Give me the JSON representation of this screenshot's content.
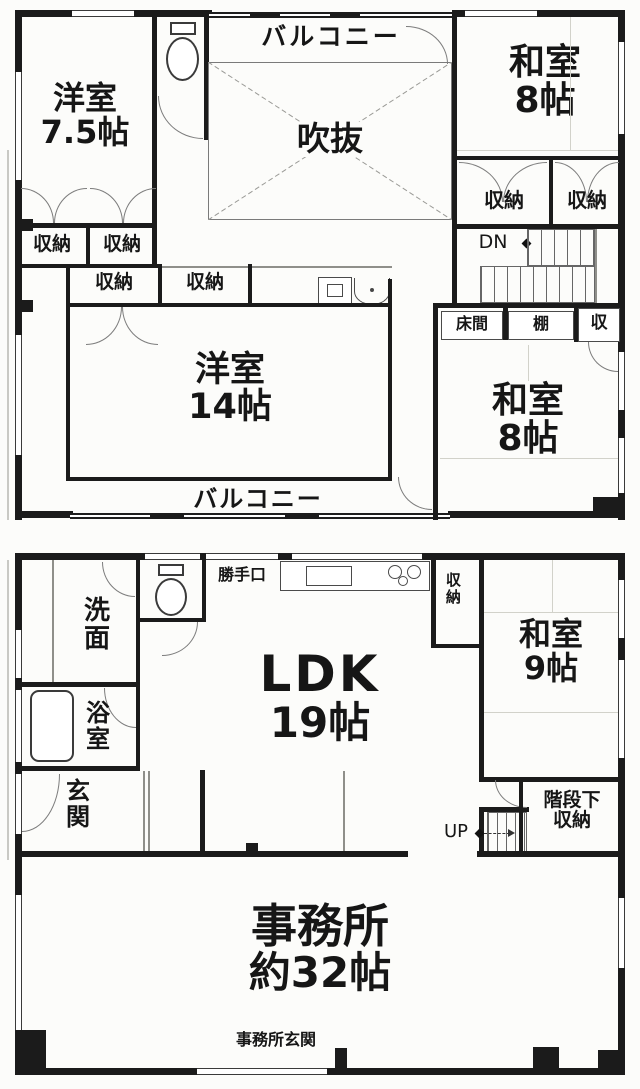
{
  "floor2": {
    "yoshitsu75": {
      "name": "洋室",
      "size": "7.5帖"
    },
    "balcony_top": "バルコニー",
    "fukinuke": "吹抜",
    "washitsu8_ne": {
      "name": "和室",
      "size": "8帖"
    },
    "closets": [
      "収納",
      "収納",
      "収納",
      "収納",
      "収納",
      "収納"
    ],
    "dn": "DN",
    "tokonoma": "床間",
    "tana": "棚",
    "shu": "収",
    "yoshitsu14": {
      "name": "洋室",
      "size": "14帖"
    },
    "washitsu8_se": {
      "name": "和室",
      "size": "8帖"
    },
    "balcony_bottom": "バルコニー"
  },
  "floor1": {
    "senmen": "洗面",
    "katteguchi": "勝手口",
    "yokushitsu": "浴室",
    "genkan": "玄関",
    "ldk": {
      "name": "LDK",
      "size": "19帖"
    },
    "shuno": "収納",
    "washitsu9": {
      "name": "和室",
      "size": "9帖"
    },
    "kaidanshita": {
      "line1": "階段下",
      "line2": "収納"
    },
    "up": "UP",
    "jimusho": {
      "name": "事務所",
      "size": "約32帖"
    },
    "jimusho_genkan": "事務所玄関"
  }
}
